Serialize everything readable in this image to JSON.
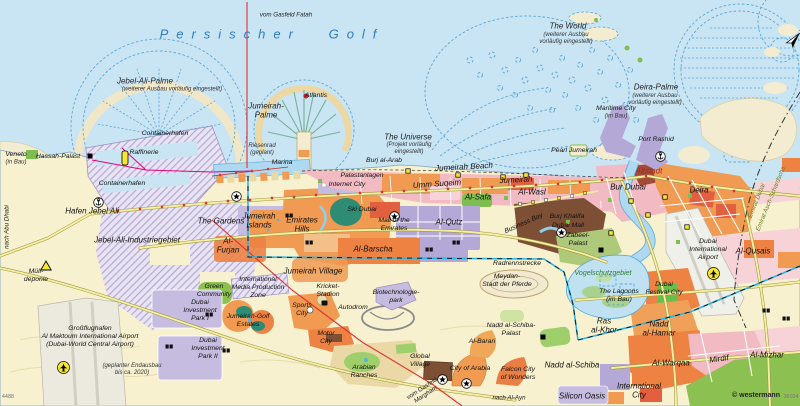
{
  "map": {
    "attribution": "© westermann",
    "attribution_code": "36034",
    "sheet_code": "4488",
    "north_label": "N"
  },
  "colors": {
    "sea": "#c9e4f3",
    "land": "#f7f1cf",
    "islandFill": "#f3ecd1",
    "islandStroke": "#5aa7d6",
    "orange": "#f09a52",
    "orange2": "#ed8243",
    "redOrange": "#e2603f",
    "pink": "#f2bac3",
    "pinkLight": "#f7d3d8",
    "purple": "#b3a8d6",
    "purpleLight": "#c6bce0",
    "brown": "#7d4f35",
    "green": "#7dbf4e",
    "greenDark": "#2e8b74",
    "greenPale": "#cfe3a2",
    "water": "#aed9f0",
    "roadYellow": "#f6efa0",
    "roadCasing": "#9a9548",
    "red": "#e03030",
    "magenta": "#e6007e",
    "cyan": "#2ab5e6",
    "seaLabel": "#2d7dc1",
    "boundary": "#333333"
  },
  "labels": [
    {
      "name": "sea-persischer-golf",
      "text": "Persischer Golf",
      "x": 272,
      "y": 34,
      "cls": "sea"
    },
    {
      "name": "pipeline-gasfeld-fatah",
      "text": "vom Gasfeld Fatah",
      "x": 286,
      "y": 15,
      "cls": "route"
    },
    {
      "name": "jebel-ali-palme",
      "text": "Jebel-Ali-Palme",
      "x": 145,
      "y": 81,
      "cls": "water"
    },
    {
      "name": "jebel-ali-palme-note",
      "text": "(weiterer Ausbau vorläufig eingestellt)",
      "x": 172,
      "y": 90,
      "cls": "note"
    },
    {
      "name": "the-world",
      "text": "The World",
      "x": 568,
      "y": 26,
      "cls": "water"
    },
    {
      "name": "the-world-note",
      "text": "(weiterer Ausbau\nvorläufig eingestellt)",
      "x": 566,
      "y": 39,
      "cls": "note"
    },
    {
      "name": "deira-palme",
      "text": "Deira-Palme",
      "x": 656,
      "y": 87,
      "cls": "water"
    },
    {
      "name": "deira-palme-note",
      "text": "(weiterer Ausbau\nvorläufig eingestellt)",
      "x": 655,
      "y": 100,
      "cls": "note"
    },
    {
      "name": "jumeirah-palme",
      "text": "Jumeirah-\nPalme",
      "x": 266,
      "y": 111,
      "cls": "water"
    },
    {
      "name": "atlantis",
      "text": "Atlantis",
      "x": 316,
      "y": 96,
      "cls": "poi"
    },
    {
      "name": "the-universe",
      "text": "The Universe",
      "x": 408,
      "y": 137,
      "cls": "water"
    },
    {
      "name": "the-universe-note",
      "text": "(Projekt vorläufig\neingestellt)",
      "x": 409,
      "y": 149,
      "cls": "note"
    },
    {
      "name": "maritime-city",
      "text": "Maritime City",
      "x": 616,
      "y": 109,
      "cls": "poi"
    },
    {
      "name": "maritime-city-note",
      "text": "(im Bau)",
      "x": 616,
      "y": 117,
      "cls": "note"
    },
    {
      "name": "port-rashid",
      "text": "Port Rashid",
      "x": 656,
      "y": 140,
      "cls": "poi"
    },
    {
      "name": "pearl-jumeirah",
      "text": "Pearl Jumeirah",
      "x": 574,
      "y": 151,
      "cls": "poi"
    },
    {
      "name": "burj-al-arab",
      "text": "Burj al-Arab",
      "x": 384,
      "y": 161,
      "cls": "poi"
    },
    {
      "name": "jumeirah-beach",
      "text": "Jumeirah Beach",
      "x": 464,
      "y": 167,
      "cls": "district",
      "rot": -3
    },
    {
      "name": "marina",
      "text": "Marina",
      "x": 282,
      "y": 163,
      "cls": "poi"
    },
    {
      "name": "riesenrad",
      "text": "Riesenrad\n(geplant)",
      "x": 262,
      "y": 150,
      "cls": "note"
    },
    {
      "name": "containerhafen-nord",
      "text": "Containerhafen",
      "x": 165,
      "y": 134,
      "cls": "poi"
    },
    {
      "name": "raffinerie",
      "text": "Raffinerie",
      "x": 144,
      "y": 153,
      "cls": "poi"
    },
    {
      "name": "containerhafen-sued",
      "text": "Containerhafen",
      "x": 122,
      "y": 184,
      "cls": "poi"
    },
    {
      "name": "hassah-palast",
      "text": "Hassah-Palast",
      "x": 58,
      "y": 157,
      "cls": "poi"
    },
    {
      "name": "veneto",
      "text": "Veneto",
      "x": 16,
      "y": 155,
      "cls": "poi"
    },
    {
      "name": "veneto-note",
      "text": "(in Bau)",
      "x": 16,
      "y": 163,
      "cls": "note"
    },
    {
      "name": "hafen-jebel-ali",
      "text": "Hafen Jebel Ali",
      "x": 92,
      "y": 211,
      "cls": "district"
    },
    {
      "name": "nach-abu-dhabi",
      "text": "nach Abu Dhabi",
      "x": 7,
      "y": 227,
      "cls": "route",
      "rot": -90
    },
    {
      "name": "jebel-ali-industriegebiet",
      "text": "Jebel-Ali-Industriegebiet",
      "x": 137,
      "y": 240,
      "cls": "district"
    },
    {
      "name": "muelldeponie",
      "text": "Müll-\ndeponie",
      "x": 36,
      "y": 276,
      "cls": "poi"
    },
    {
      "name": "green-community",
      "text": "Green\nCommunity",
      "x": 214,
      "y": 291,
      "cls": "poi"
    },
    {
      "name": "dubai-investment-park-1",
      "text": "Dubai\nInvestment\nPark I",
      "x": 200,
      "y": 311,
      "cls": "poi"
    },
    {
      "name": "dubai-investment-park-2",
      "text": "Dubai\nInvestment\nPark II",
      "x": 208,
      "y": 349,
      "cls": "poi"
    },
    {
      "name": "al-maktoum-airport",
      "text": "Großflughafen\nAl Maktoum International Airport\n(Dubai-World Central Airport)",
      "x": 90,
      "y": 337,
      "cls": "poi"
    },
    {
      "name": "endausbau-note",
      "text": "(geplanter Endausbau\nbis ca. 2020)",
      "x": 132,
      "y": 370,
      "cls": "note"
    },
    {
      "name": "the-gardens",
      "text": "The Gardens",
      "x": 221,
      "y": 221,
      "cls": "district"
    },
    {
      "name": "jumeirah-islands",
      "text": "Jumeirah\nIslands",
      "x": 259,
      "y": 221,
      "cls": "district"
    },
    {
      "name": "emirates-hills",
      "text": "Emirates\nHills",
      "x": 302,
      "y": 225,
      "cls": "district"
    },
    {
      "name": "al-furjan",
      "text": "Al-\nFurjan",
      "x": 228,
      "y": 246,
      "cls": "district"
    },
    {
      "name": "impz",
      "text": "International\nMedia Production\nZone",
      "x": 258,
      "y": 288,
      "cls": "poi"
    },
    {
      "name": "jumeirah-golf-estates",
      "text": "Jumeirah-Golf\nEstates",
      "x": 248,
      "y": 321,
      "cls": "poi"
    },
    {
      "name": "sports-city",
      "text": "Sports\nCity",
      "x": 302,
      "y": 310,
      "cls": "poi"
    },
    {
      "name": "kricket-stadion",
      "text": "Kricket-\nStadion",
      "x": 328,
      "y": 291,
      "cls": "poi"
    },
    {
      "name": "jumeirah-village",
      "text": "Jumeirah Village",
      "x": 313,
      "y": 271,
      "cls": "district"
    },
    {
      "name": "autodrom",
      "text": "Autodrom",
      "x": 353,
      "y": 308,
      "cls": "poi"
    },
    {
      "name": "biotechnologiepark",
      "text": "Biotechnologie-\npark",
      "x": 396,
      "y": 297,
      "cls": "poi"
    },
    {
      "name": "motor-city",
      "text": "Motor\nCity",
      "x": 326,
      "y": 338,
      "cls": "poi"
    },
    {
      "name": "arabian-ranches",
      "text": "Arabian\nRanches",
      "x": 364,
      "y": 372,
      "cls": "poi"
    },
    {
      "name": "global-village",
      "text": "Global\nVillage",
      "x": 420,
      "y": 361,
      "cls": "poi"
    },
    {
      "name": "city-of-arabia",
      "text": "City of Arabia",
      "x": 470,
      "y": 369,
      "cls": "poi"
    },
    {
      "name": "al-barari",
      "text": "Al-Barari",
      "x": 482,
      "y": 342,
      "cls": "poi"
    },
    {
      "name": "falcon-city-of-wonders",
      "text": "Falcon City\nof Wonders",
      "x": 518,
      "y": 374,
      "cls": "poi"
    },
    {
      "name": "nadd-al-schiba-palast",
      "text": "Nadd al-Schiba-\nPalast",
      "x": 511,
      "y": 330,
      "cls": "poi"
    },
    {
      "name": "pipeline-gasfeld-margham",
      "text": "vom Gasfeld\nMargham",
      "x": 424,
      "y": 392,
      "cls": "route",
      "rot": -33
    },
    {
      "name": "nach-al-ayn",
      "text": "nach Al-Ayn",
      "x": 509,
      "y": 398,
      "cls": "route"
    },
    {
      "name": "silicon-oasis",
      "text": "Silicon Oasis",
      "x": 582,
      "y": 396,
      "cls": "district"
    },
    {
      "name": "nadd-al-schiba",
      "text": "Nadd al-Schiba",
      "x": 572,
      "y": 365,
      "cls": "district"
    },
    {
      "name": "ras-al-khor",
      "text": "Ras\nal-Khor",
      "x": 604,
      "y": 326,
      "cls": "district"
    },
    {
      "name": "the-lagoons",
      "text": "The Lagoons\n(im Bau)",
      "x": 619,
      "y": 296,
      "cls": "poi"
    },
    {
      "name": "vogelschutzgebiet",
      "text": "Vogelschutzgebiet",
      "x": 603,
      "y": 274,
      "cls": "nature"
    },
    {
      "name": "dubai-festival-city",
      "text": "Dubai\nFestival City",
      "x": 664,
      "y": 289,
      "cls": "poi"
    },
    {
      "name": "nadd-al-hamar",
      "text": "Nadd\nal-Hamar",
      "x": 659,
      "y": 329,
      "cls": "district"
    },
    {
      "name": "al-warqaa",
      "text": "Al-Warqaa",
      "x": 671,
      "y": 363,
      "cls": "district"
    },
    {
      "name": "mirdif",
      "text": "Mirdif",
      "x": 719,
      "y": 359,
      "cls": "district",
      "rot": -8
    },
    {
      "name": "al-mizhar",
      "text": "Al-Mizhar",
      "x": 767,
      "y": 355,
      "cls": "district"
    },
    {
      "name": "international-city",
      "text": "International\nCity",
      "x": 639,
      "y": 391,
      "cls": "district"
    },
    {
      "name": "palastanlagen",
      "text": "Palastanlagen",
      "x": 362,
      "y": 176,
      "cls": "poi"
    },
    {
      "name": "internet-city",
      "text": "Internet City",
      "x": 347,
      "y": 185,
      "cls": "poi"
    },
    {
      "name": "ski-dubai",
      "text": "Ski Dubai",
      "x": 362,
      "y": 210,
      "cls": "poi"
    },
    {
      "name": "mall-of-the-emirates",
      "text": "Mall of the\nEmirates",
      "x": 394,
      "y": 225,
      "cls": "poi"
    },
    {
      "name": "umm-suqeim",
      "text": "Umm Suqeim",
      "x": 437,
      "y": 184,
      "cls": "district",
      "rot": -4
    },
    {
      "name": "jumeirah",
      "text": "Jumeirah",
      "x": 516,
      "y": 180,
      "cls": "district",
      "rot": -3
    },
    {
      "name": "al-wasl",
      "text": "Al-Wasl",
      "x": 532,
      "y": 192,
      "cls": "district"
    },
    {
      "name": "al-safa",
      "text": "Al-Safa",
      "x": 478,
      "y": 197,
      "cls": "district"
    },
    {
      "name": "al-qutz",
      "text": "Al-Qutz",
      "x": 449,
      "y": 222,
      "cls": "district"
    },
    {
      "name": "al-barscha",
      "text": "Al-Barscha",
      "x": 373,
      "y": 249,
      "cls": "district"
    },
    {
      "name": "business-bay",
      "text": "Business Bay",
      "x": 524,
      "y": 224,
      "cls": "poi",
      "rot": -24
    },
    {
      "name": "burj-khalifa",
      "text": "Burj Khalifa",
      "x": 567,
      "y": 217,
      "cls": "poi"
    },
    {
      "name": "dubai-mall",
      "text": "Dubai Mall",
      "x": 568,
      "y": 226,
      "cls": "poi"
    },
    {
      "name": "zabeel-palast",
      "text": "Zabeel-\nPalast",
      "x": 578,
      "y": 240,
      "cls": "poi"
    },
    {
      "name": "radrennstrecke",
      "text": "Radrennstrecke",
      "x": 517,
      "y": 264,
      "cls": "poi"
    },
    {
      "name": "meydan",
      "text": "Meydan-\nStadt der Pferde",
      "x": 507,
      "y": 281,
      "cls": "poi"
    },
    {
      "name": "bur-dubai",
      "text": "Bur Dubai",
      "x": 628,
      "y": 187,
      "cls": "district"
    },
    {
      "name": "altstadt",
      "text": "Altstadt",
      "x": 649,
      "y": 171,
      "cls": "district red"
    },
    {
      "name": "deira",
      "text": "Deira",
      "x": 699,
      "y": 190,
      "cls": "district"
    },
    {
      "name": "dubai-international-airport",
      "text": "Dubai\nInternational\nAirport",
      "x": 708,
      "y": 250,
      "cls": "poi"
    },
    {
      "name": "al-qusais",
      "text": "Al-Qusais",
      "x": 753,
      "y": 251,
      "cls": "district"
    },
    {
      "name": "emirat-dubai",
      "text": "Emirat Dubai",
      "x": 757,
      "y": 201,
      "cls": "emirate",
      "rot": -68
    },
    {
      "name": "emirat-schardscha",
      "text": "Emirat Asch-Schardscha",
      "x": 771,
      "y": 199,
      "cls": "emirate",
      "rot": -68
    },
    {
      "name": "attribution",
      "text": "© westermann",
      "x": 756,
      "y": 396,
      "cls": "credit"
    },
    {
      "name": "attribution-code",
      "text": "36034",
      "x": 791,
      "y": 397,
      "cls": "tiny"
    },
    {
      "name": "sheet-code",
      "text": "4488",
      "x": 8,
      "y": 397,
      "cls": "tiny"
    }
  ],
  "icons": [
    {
      "name": "anchor-hafen-jebel-ali-icon",
      "type": "anchor",
      "x": 93,
      "y": 197
    },
    {
      "name": "anchor-port-rashid-icon",
      "type": "anchor",
      "x": 655,
      "y": 151
    },
    {
      "name": "airplane-al-maktoum-icon",
      "type": "plane",
      "x": 57,
      "y": 361
    },
    {
      "name": "airplane-dubai-intl-icon",
      "type": "plane",
      "x": 707,
      "y": 267
    },
    {
      "name": "muelldeponie-warning-icon",
      "type": "warning",
      "x": 40,
      "y": 260
    },
    {
      "name": "hassah-palast-icon",
      "type": "palace",
      "x": 87,
      "y": 153
    },
    {
      "name": "zabeel-palast-icon",
      "type": "palace",
      "x": 598,
      "y": 247
    },
    {
      "name": "nadd-al-schiba-palast-icon",
      "type": "palace",
      "x": 540,
      "y": 334
    },
    {
      "name": "kricket-stadion-icon",
      "type": "stadium",
      "x": 321,
      "y": 300
    },
    {
      "name": "ibn-battuta-mall-icon",
      "type": "mall",
      "x": 231,
      "y": 191
    },
    {
      "name": "mall-of-the-emirates-icon",
      "type": "mall",
      "x": 389,
      "y": 211
    },
    {
      "name": "dubai-mall-icon",
      "type": "mall",
      "x": 556,
      "y": 227
    },
    {
      "name": "global-village-icon",
      "type": "mall",
      "x": 437,
      "y": 374
    },
    {
      "name": "city-of-arabia-icon",
      "type": "mall",
      "x": 461,
      "y": 378
    },
    {
      "name": "atlantis-icon",
      "type": "dotRed",
      "x": 303,
      "y": 93
    },
    {
      "name": "burj-al-arab-icon",
      "type": "poiY",
      "x": 405,
      "y": 168
    },
    {
      "name": "beach-hotel-icon-1",
      "type": "poiY",
      "x": 455,
      "y": 172
    },
    {
      "name": "beach-hotel-icon-2",
      "type": "poiY",
      "x": 500,
      "y": 174
    },
    {
      "name": "beach-hotel-icon-3",
      "type": "poiY",
      "x": 523,
      "y": 172
    },
    {
      "name": "poi-icon-deira-1",
      "type": "poiY",
      "x": 628,
      "y": 198
    },
    {
      "name": "poi-icon-deira-2",
      "type": "poiY",
      "x": 645,
      "y": 212
    },
    {
      "name": "poi-icon-deira-3",
      "type": "poiY",
      "x": 662,
      "y": 194
    },
    {
      "name": "poi-icon-bur-dubai",
      "type": "poiY",
      "x": 608,
      "y": 230
    },
    {
      "name": "poi-icon-deira-4",
      "type": "poiY",
      "x": 684,
      "y": 224
    },
    {
      "name": "industry-icon-1",
      "type": "industry",
      "x": 285,
      "y": 213
    },
    {
      "name": "industry-icon-2",
      "type": "industry",
      "x": 305,
      "y": 240
    },
    {
      "name": "industry-icon-3",
      "type": "industry",
      "x": 425,
      "y": 247
    },
    {
      "name": "industry-icon-4",
      "type": "industry",
      "x": 452,
      "y": 240
    },
    {
      "name": "industry-icon-5",
      "type": "industry",
      "x": 205,
      "y": 312
    },
    {
      "name": "industry-icon-6",
      "type": "industry",
      "x": 222,
      "y": 348
    },
    {
      "name": "industry-icon-7",
      "type": "industry",
      "x": 165,
      "y": 344
    },
    {
      "name": "industry-icon-8",
      "type": "industry",
      "x": 762,
      "y": 308
    },
    {
      "name": "industry-icon-9",
      "type": "industry",
      "x": 782,
      "y": 316
    },
    {
      "name": "raffinerie-tank-icon",
      "type": "tank",
      "x": 121,
      "y": 150
    },
    {
      "name": "north-arrow",
      "type": "north",
      "x": 779,
      "y": 25
    }
  ]
}
